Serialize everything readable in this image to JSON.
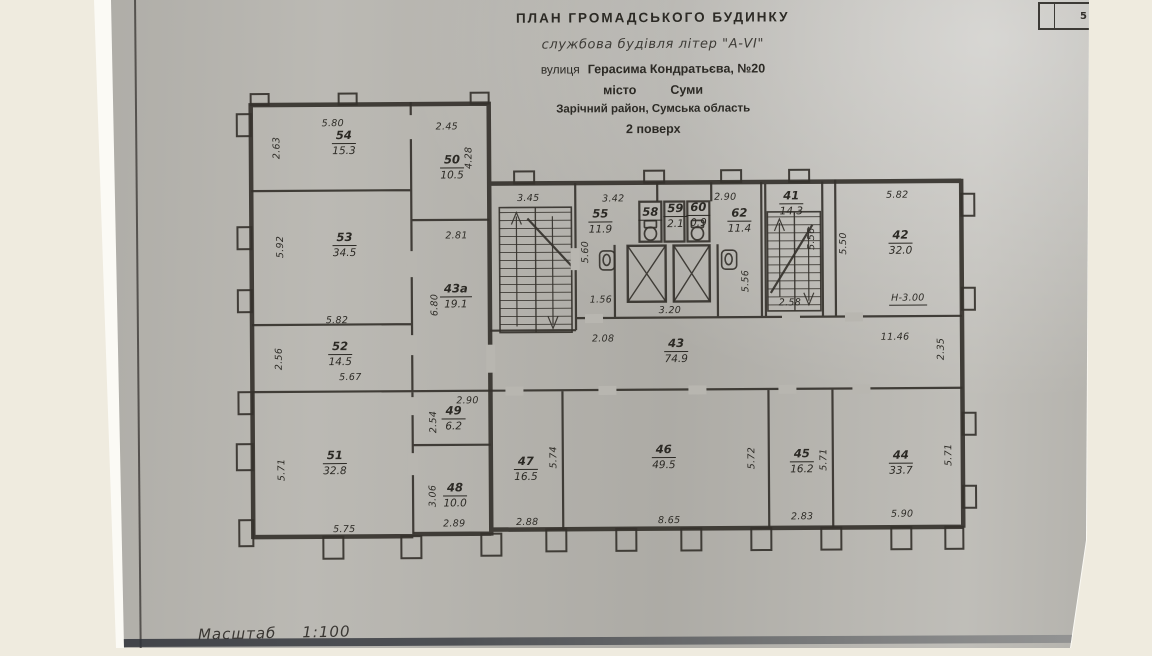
{
  "page": {
    "sheet_number": "5",
    "scale_label": "Масштаб",
    "scale_value": "1:100",
    "colors": {
      "paper_gray": "#b6b4ae",
      "ink": "#33302b",
      "background": "#efebdf",
      "page_white": "#fbfaf5"
    }
  },
  "header": {
    "title": "ПЛАН  ГРОМАДСЬКОГО  БУДИНКУ",
    "subtitle": "службова будівля літер \"А-VI\"",
    "street_label": "вулиця",
    "street": "Герасима Кондратьєва, №20",
    "city_label": "місто",
    "city": "Суми",
    "district": "Зарічний район, Сумська область",
    "floor": "2 поверх"
  },
  "plan": {
    "icons": [
      "staircase-icon",
      "staircase-icon",
      "elevator-shaft-icon",
      "elevator-shaft-icon",
      "toilet-icon",
      "toilet-icon",
      "sink-icon",
      "sink-icon"
    ],
    "rooms": [
      {
        "number": "54",
        "area": "15.3",
        "pos": [
          345,
          141
        ]
      },
      {
        "number": "50",
        "area": "10.5",
        "pos": [
          453,
          166
        ]
      },
      {
        "number": "53",
        "area": "34.5",
        "pos": [
          345,
          243
        ]
      },
      {
        "number": "43а",
        "area": "19.1",
        "pos": [
          456,
          295
        ]
      },
      {
        "number": "52",
        "area": "14.5",
        "pos": [
          340,
          352
        ]
      },
      {
        "number": "55",
        "area": "11.9",
        "pos": [
          601,
          221
        ]
      },
      {
        "number": "58",
        "area": "",
        "pos": [
          651,
          213
        ]
      },
      {
        "number": "59",
        "area": "2.1",
        "pos": [
          676,
          216
        ]
      },
      {
        "number": "60",
        "area": "0.9",
        "pos": [
          699,
          215
        ]
      },
      {
        "number": "62",
        "area": "11.4",
        "pos": [
          740,
          221
        ]
      },
      {
        "number": "41",
        "area": "14.3",
        "pos": [
          792,
          204
        ]
      },
      {
        "number": "42",
        "area": "32.0",
        "pos": [
          901,
          244
        ]
      },
      {
        "number": "43",
        "area": "74.9",
        "pos": [
          676,
          351
        ]
      },
      {
        "number": "49",
        "area": "6.2",
        "pos": [
          453,
          417
        ]
      },
      {
        "number": "48",
        "area": "10.0",
        "pos": [
          454,
          494
        ]
      },
      {
        "number": "51",
        "area": "32.8",
        "pos": [
          334,
          461
        ]
      },
      {
        "number": "47",
        "area": "16.5",
        "pos": [
          525,
          468
        ]
      },
      {
        "number": "46",
        "area": "49.5",
        "pos": [
          663,
          457
        ]
      },
      {
        "number": "45",
        "area": "16.2",
        "pos": [
          801,
          462
        ]
      },
      {
        "number": "44",
        "area": "33.7",
        "pos": [
          900,
          464
        ]
      }
    ],
    "dimensions": [
      {
        "text": "5.80",
        "pos": [
          334,
          122
        ]
      },
      {
        "text": "2.63",
        "pos": [
          278,
          146
        ],
        "v": 1
      },
      {
        "text": "2.45",
        "pos": [
          448,
          126
        ]
      },
      {
        "text": "4.28",
        "pos": [
          470,
          157
        ],
        "v": 1
      },
      {
        "text": "5.92",
        "pos": [
          281,
          245
        ],
        "v": 1
      },
      {
        "text": "2.81",
        "pos": [
          457,
          235
        ]
      },
      {
        "text": "5.82",
        "pos": [
          337,
          319
        ]
      },
      {
        "text": "6.80",
        "pos": [
          435,
          304
        ],
        "v": 1
      },
      {
        "text": "2.56",
        "pos": [
          279,
          357
        ],
        "v": 1
      },
      {
        "text": "5.67",
        "pos": [
          350,
          376
        ]
      },
      {
        "text": "3.45",
        "pos": [
          529,
          198
        ]
      },
      {
        "text": "3.42",
        "pos": [
          614,
          199
        ]
      },
      {
        "text": "2.90",
        "pos": [
          726,
          198
        ]
      },
      {
        "text": "5.60",
        "pos": [
          586,
          252
        ],
        "v": 1
      },
      {
        "text": "1.56",
        "pos": [
          601,
          300
        ]
      },
      {
        "text": "2.08",
        "pos": [
          603,
          339
        ]
      },
      {
        "text": "3.20",
        "pos": [
          670,
          311
        ]
      },
      {
        "text": "5.56",
        "pos": [
          746,
          282
        ],
        "v": 1
      },
      {
        "text": "5.56",
        "pos": [
          812,
          240
        ],
        "v": 1
      },
      {
        "text": "2.58",
        "pos": [
          790,
          304
        ]
      },
      {
        "text": "5.50",
        "pos": [
          844,
          245
        ],
        "v": 1
      },
      {
        "text": "5.82",
        "pos": [
          898,
          197
        ]
      },
      {
        "text": "Н-3.00",
        "pos": [
          908,
          301
        ],
        "u": 1
      },
      {
        "text": "11.46",
        "pos": [
          895,
          339
        ]
      },
      {
        "text": "2.35",
        "pos": [
          941,
          351
        ],
        "v": 1
      },
      {
        "text": "2.90",
        "pos": [
          467,
          400
        ]
      },
      {
        "text": "2.54",
        "pos": [
          433,
          421
        ],
        "v": 1
      },
      {
        "text": "3.06",
        "pos": [
          432,
          495
        ],
        "v": 1
      },
      {
        "text": "2.89",
        "pos": [
          453,
          523
        ]
      },
      {
        "text": "5.71",
        "pos": [
          281,
          468
        ],
        "v": 1
      },
      {
        "text": "5.75",
        "pos": [
          343,
          528
        ]
      },
      {
        "text": "5.74",
        "pos": [
          553,
          457
        ],
        "v": 1
      },
      {
        "text": "2.88",
        "pos": [
          526,
          522
        ]
      },
      {
        "text": "5.72",
        "pos": [
          751,
          459
        ],
        "v": 1
      },
      {
        "text": "8.65",
        "pos": [
          668,
          521
        ]
      },
      {
        "text": "5.71",
        "pos": [
          823,
          461
        ],
        "v": 1
      },
      {
        "text": "2.83",
        "pos": [
          801,
          518
        ]
      },
      {
        "text": "5.71",
        "pos": [
          948,
          457
        ],
        "v": 1
      },
      {
        "text": "5.90",
        "pos": [
          901,
          516
        ]
      }
    ]
  }
}
